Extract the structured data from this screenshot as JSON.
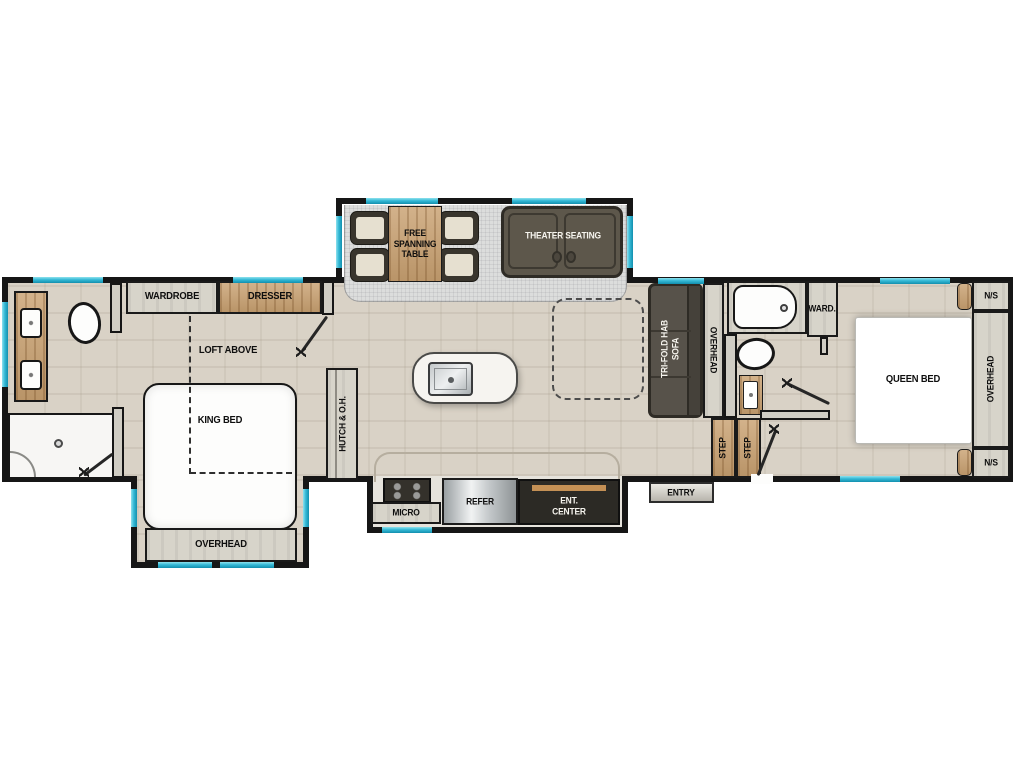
{
  "labels": {
    "wardrobe": "WARDROBE",
    "dresser": "DRESSER",
    "loft_above": "LOFT ABOVE",
    "king_bed": "KING BED",
    "overhead_front": "OVERHEAD",
    "hutch": "HUTCH & O.H.",
    "free_spanning_table": "FREE\nSPANNING\nTABLE",
    "theater_seating": "THEATER SEATING",
    "tri_fold_sofa": "TRI-FOLD HAB\nSOFA",
    "overhead_sofa": "OVERHEAD",
    "ward": "WARD.",
    "step_left": "STEP",
    "step_right": "STEP",
    "micro": "MICRO",
    "refer": "REFER",
    "ent_center": "ENT.\nCENTER",
    "entry": "ENTRY",
    "queen_bed": "QUEEN BED",
    "ns_top": "N/S",
    "overhead_bedroom": "OVERHEAD",
    "ns_bottom": "N/S"
  },
  "colors": {
    "wall": "#161616",
    "floor": "#d9d2c6",
    "carpet": "#dcdddc",
    "wood": "#c9a171",
    "cabinet": "#d7d4ca",
    "sofa": "#5d574b",
    "window": "#35b9d6",
    "accent_wood": "#c49055"
  }
}
